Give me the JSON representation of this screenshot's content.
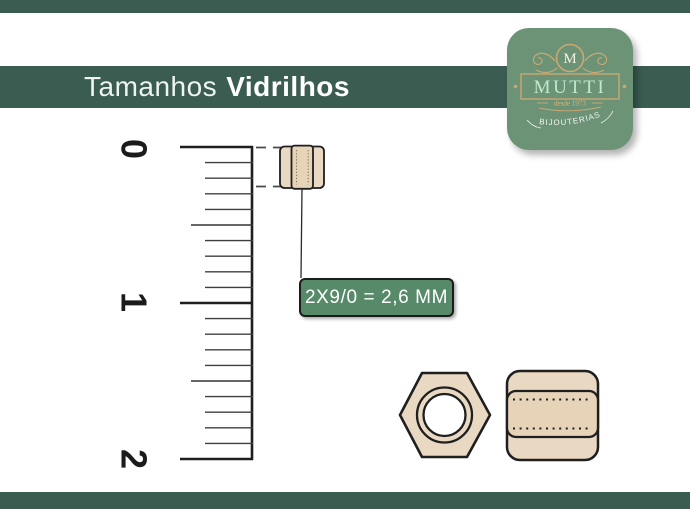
{
  "header": {
    "title_regular": "Tamanhos",
    "title_bold": "Vidrilhos"
  },
  "logo": {
    "monogram": "M",
    "brand": "MUTTI",
    "since": "desde 1973",
    "tagline": "BIJOUTERIAS"
  },
  "ruler": {
    "marks": [
      "0",
      "1",
      "2"
    ]
  },
  "measurement": {
    "label": "2X9/0 = 2,6 MM",
    "size_code": "2X9/0",
    "size_mm": "2,6 MM"
  },
  "colors": {
    "bar_green": "#3b5d51",
    "label_green": "#578a69",
    "logo_green": "#6d9377",
    "bead_beige": "#ead9c2",
    "outline_dark": "#1f1f1f",
    "mint": "#bfe9cf",
    "gold": "#c9a873"
  }
}
